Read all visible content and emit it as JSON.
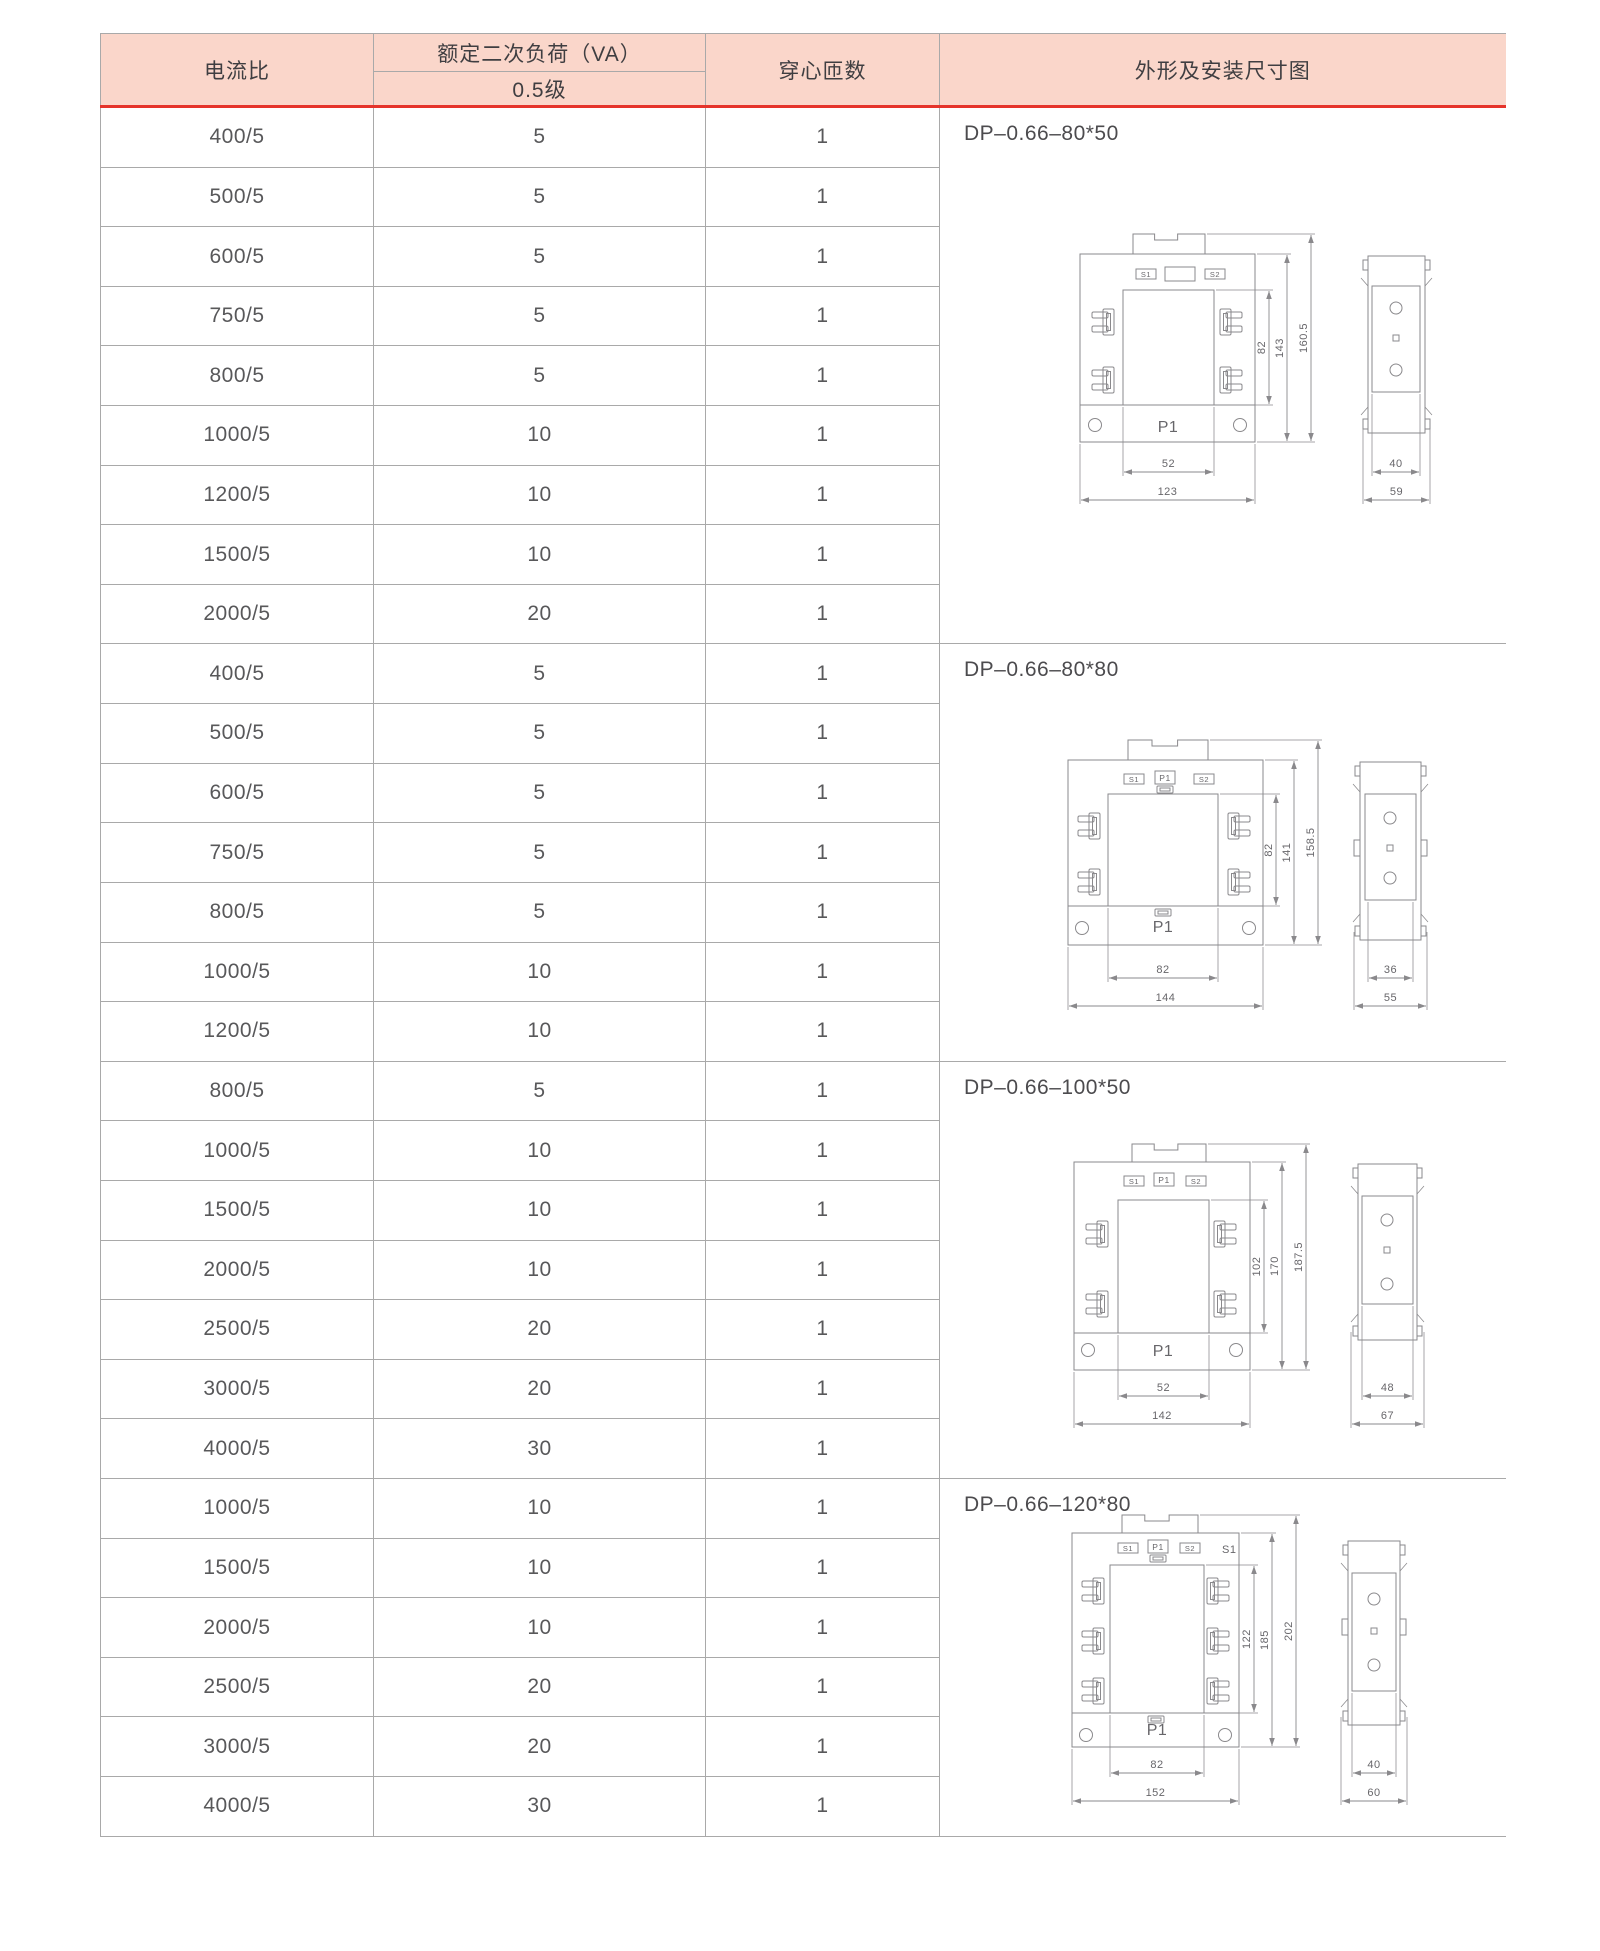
{
  "colors": {
    "header_bg": "#fad6ca",
    "accent_red": "#e5342b",
    "border": "#a9a9a9",
    "cell_text": "#58585a",
    "header_text": "#3f3e41",
    "drawing_line": "#8a898c"
  },
  "table": {
    "headers": {
      "current_ratio": "电流比",
      "rated_load": "额定二次负荷（VA）",
      "rated_load_class": "0.5级",
      "turns": "穿心匝数",
      "drawing": "外形及安装尺寸图"
    },
    "groups": [
      {
        "title": "DP–0.66–80*50",
        "rows": [
          {
            "ratio": "400/5",
            "load": "5",
            "turns": "1"
          },
          {
            "ratio": "500/5",
            "load": "5",
            "turns": "1"
          },
          {
            "ratio": "600/5",
            "load": "5",
            "turns": "1"
          },
          {
            "ratio": "750/5",
            "load": "5",
            "turns": "1"
          },
          {
            "ratio": "800/5",
            "load": "5",
            "turns": "1"
          },
          {
            "ratio": "1000/5",
            "load": "10",
            "turns": "1"
          },
          {
            "ratio": "1200/5",
            "load": "10",
            "turns": "1"
          },
          {
            "ratio": "1500/5",
            "load": "10",
            "turns": "1"
          },
          {
            "ratio": "2000/5",
            "load": "20",
            "turns": "1"
          }
        ]
      },
      {
        "title": "DP–0.66–80*80",
        "rows": [
          {
            "ratio": "400/5",
            "load": "5",
            "turns": "1"
          },
          {
            "ratio": "500/5",
            "load": "5",
            "turns": "1"
          },
          {
            "ratio": "600/5",
            "load": "5",
            "turns": "1"
          },
          {
            "ratio": "750/5",
            "load": "5",
            "turns": "1"
          },
          {
            "ratio": "800/5",
            "load": "5",
            "turns": "1"
          },
          {
            "ratio": "1000/5",
            "load": "10",
            "turns": "1"
          },
          {
            "ratio": "1200/5",
            "load": "10",
            "turns": "1"
          }
        ]
      },
      {
        "title": "DP–0.66–100*50",
        "rows": [
          {
            "ratio": "800/5",
            "load": "5",
            "turns": "1"
          },
          {
            "ratio": "1000/5",
            "load": "10",
            "turns": "1"
          },
          {
            "ratio": "1500/5",
            "load": "10",
            "turns": "1"
          },
          {
            "ratio": "2000/5",
            "load": "10",
            "turns": "1"
          },
          {
            "ratio": "2500/5",
            "load": "20",
            "turns": "1"
          },
          {
            "ratio": "3000/5",
            "load": "20",
            "turns": "1"
          },
          {
            "ratio": "4000/5",
            "load": "30",
            "turns": "1"
          }
        ]
      },
      {
        "title": "DP–0.66–120*80",
        "rows": [
          {
            "ratio": "1000/5",
            "load": "10",
            "turns": "1"
          },
          {
            "ratio": "1500/5",
            "load": "10",
            "turns": "1"
          },
          {
            "ratio": "2000/5",
            "load": "10",
            "turns": "1"
          },
          {
            "ratio": "2500/5",
            "load": "20",
            "turns": "1"
          },
          {
            "ratio": "3000/5",
            "load": "20",
            "turns": "1"
          },
          {
            "ratio": "4000/5",
            "load": "30",
            "turns": "1"
          }
        ]
      }
    ]
  },
  "diagrams": [
    {
      "front": {
        "s1": "S1",
        "s2": "S2",
        "p1_bottom": "P1",
        "window_h": "82",
        "body_h": "143",
        "total_h": "160.5",
        "window_w": "52",
        "body_w": "123"
      },
      "side": {
        "inner_w": "40",
        "outer_w": "59"
      }
    },
    {
      "front": {
        "s1": "S1",
        "p1": "P1",
        "s2": "S2",
        "p1_bottom": "P1",
        "window_h": "82",
        "body_h": "141",
        "total_h": "158.5",
        "window_w": "82",
        "body_w": "144"
      },
      "side": {
        "inner_w": "36",
        "outer_w": "55"
      }
    },
    {
      "front": {
        "s1": "S1",
        "p1": "P1",
        "s2": "S2",
        "p1_bottom": "P1",
        "window_h": "102",
        "body_h": "170",
        "total_h": "187.5",
        "window_w": "52",
        "body_w": "142"
      },
      "side": {
        "inner_w": "48",
        "outer_w": "67"
      }
    },
    {
      "front": {
        "s1": "S1",
        "p1": "P1",
        "s2": "S2",
        "p1_bottom": "P1",
        "corner_label": "S1",
        "window_h": "122",
        "body_h": "185",
        "total_h": "202",
        "window_w": "82",
        "body_w": "152"
      },
      "side": {
        "inner_w": "40",
        "outer_w": "60"
      }
    }
  ]
}
